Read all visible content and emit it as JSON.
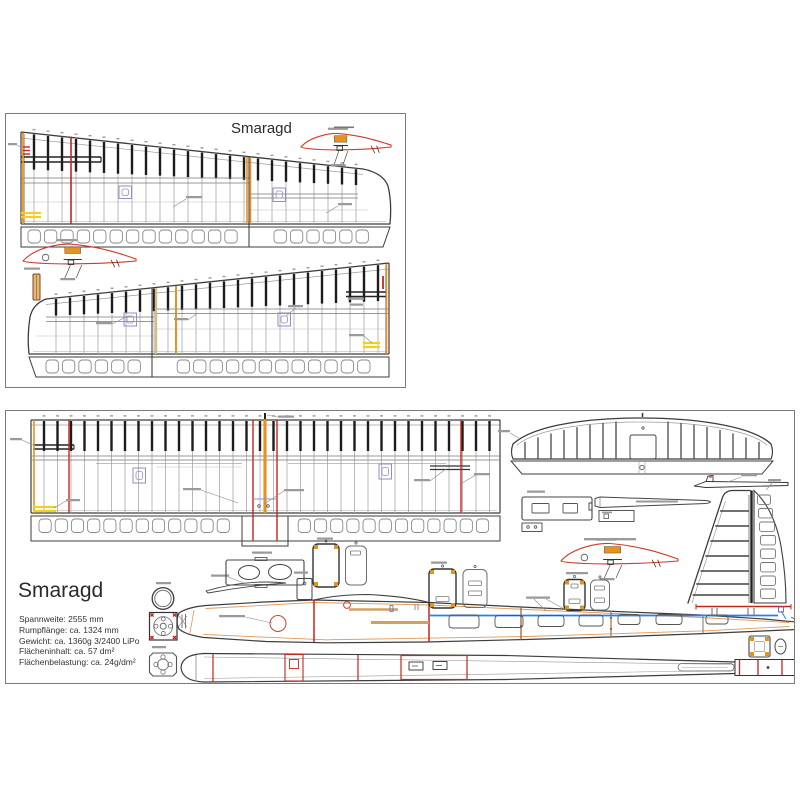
{
  "top_sheet": {
    "title": "Smaragd"
  },
  "bottom_sheet": {
    "title": "Smaragd",
    "specs": [
      "Spannweite: 2555 mm",
      "Rumpflänge: ca. 1324 mm",
      "Gewicht: ca. 1360g 3/2400 LiPo",
      "Flächeninhalt: ca. 57 dm²",
      "Flächenbelastung: ca. 24g/dm²"
    ]
  },
  "colors": {
    "line": "#3d3d3d",
    "rib": "#a8a8a8",
    "sparcap": "#1c1c1c",
    "red": "#c2271d",
    "airfoil_red": "#cf3b28",
    "orange": "#e8921e",
    "tan": "#d2a060",
    "yellow": "#f0d020",
    "purple": "#8f8fca",
    "blue": "#2b7fe8",
    "brown": "#b06a3a",
    "labelbar": "#9a9a9a"
  }
}
